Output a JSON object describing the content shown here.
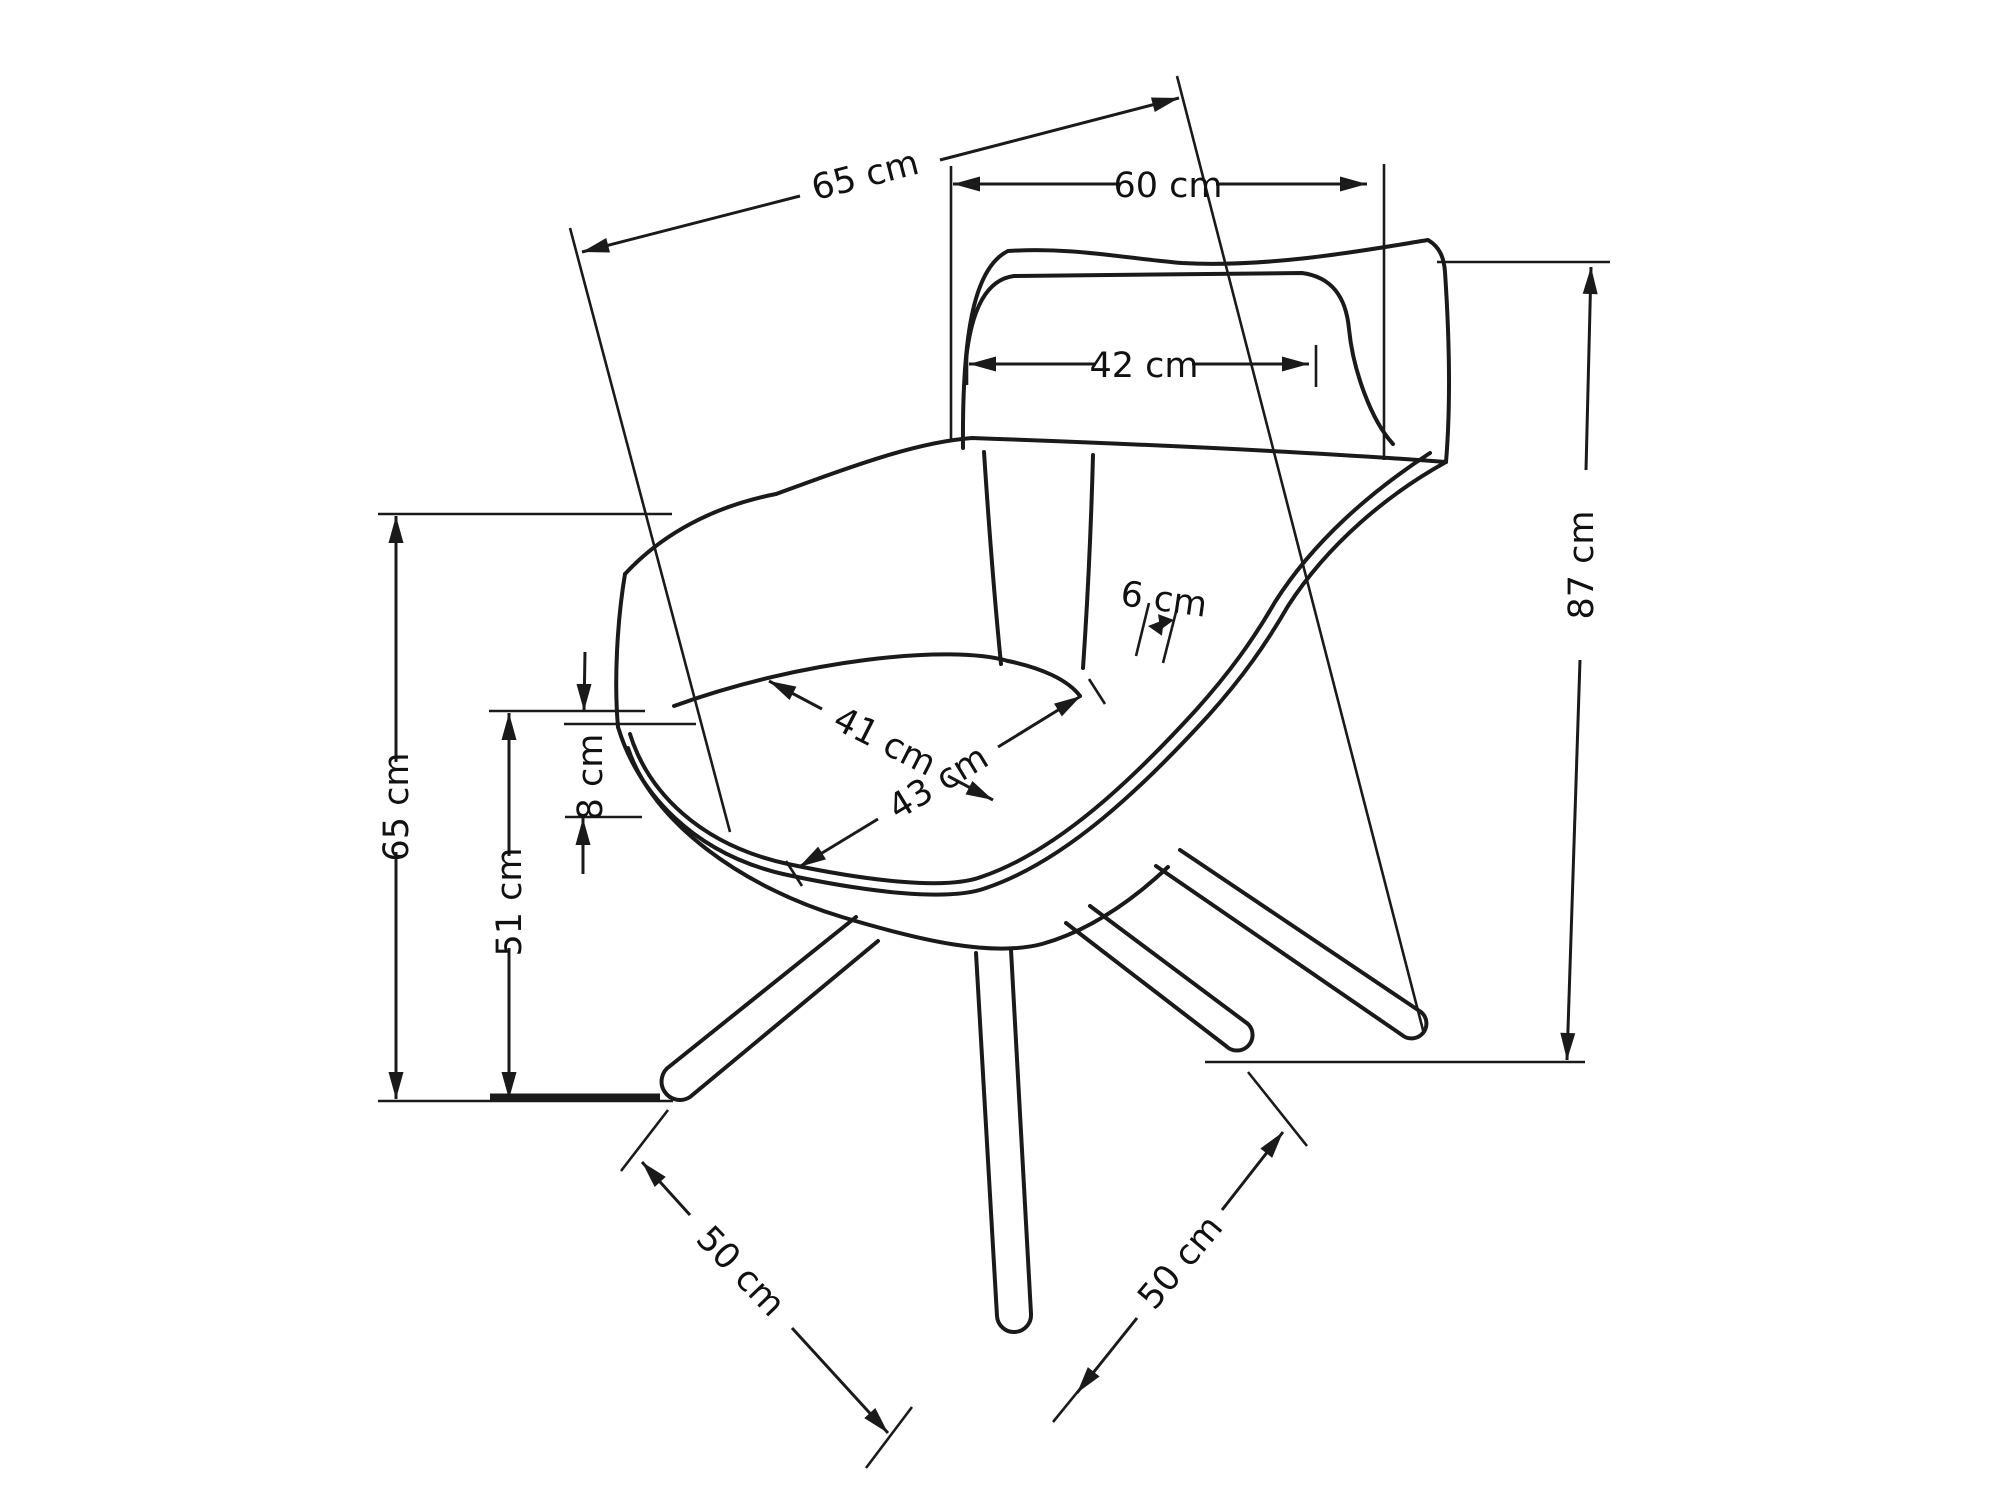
{
  "page": {
    "background": "#ffffff",
    "line_color": "#1a1a1a",
    "unit": "cm"
  },
  "diagram": {
    "kind": "furniture dimension line drawing",
    "subject": "swivel armchair, perspective view, technical measurement sketch",
    "measurements": {
      "overall_depth_cm": 65,
      "backrest_width_cm": 60,
      "headrest_width_cm": 42,
      "rim_thickness_cm": 6,
      "seat_depth_cm": 41,
      "seat_width_cm": 43,
      "overall_height_cm": 87,
      "armrest_height_cm": 65,
      "seat_height_cm": 51,
      "cushion_thickness_cm": 8,
      "base_span_left_cm": 50,
      "base_span_right_cm": 50
    }
  },
  "dimensions": [
    {
      "id": "overall-depth",
      "label": "65 cm",
      "value": 65,
      "segments": [
        [
          582,
          252,
          800,
          196
        ],
        [
          940,
          160,
          1179,
          98
        ]
      ],
      "arrows": [
        [
          582,
          252,
          165.5
        ],
        [
          1179,
          98,
          -14.5
        ]
      ],
      "exts": [
        [
          570,
          228,
          730,
          832
        ],
        [
          1177,
          76,
          1424,
          1034
        ]
      ],
      "text": [
        865,
        175,
        -14.5
      ]
    },
    {
      "id": "backrest-width",
      "label": "60 cm",
      "value": 60,
      "segments": [
        [
          953,
          184,
          1120,
          184
        ],
        [
          1216,
          184,
          1367,
          184
        ]
      ],
      "arrows": [
        [
          953,
          184,
          180
        ],
        [
          1367,
          184,
          0
        ]
      ],
      "exts": [
        [
          951,
          166,
          951,
          442
        ],
        [
          1384,
          164,
          1384,
          460
        ]
      ],
      "text": [
        1168,
        185,
        0
      ]
    },
    {
      "id": "headrest-width",
      "label": "42 cm",
      "value": 42,
      "segments": [
        [
          969,
          364,
          1096,
          364
        ],
        [
          1192,
          364,
          1309,
          364
        ]
      ],
      "arrows": [
        [
          969,
          364,
          180
        ],
        [
          1309,
          364,
          0
        ]
      ],
      "exts": [
        [
          967,
          345,
          967,
          385
        ],
        [
          1316,
          345,
          1316,
          387
        ]
      ],
      "text": [
        1144,
        365,
        0
      ]
    },
    {
      "id": "rim-thickness",
      "label": "6 cm",
      "value": 6,
      "alen": 15,
      "aw": 16,
      "segments": [],
      "arrows": [
        [
          1148,
          626,
          187
        ],
        [
          1174,
          620,
          -8
        ]
      ],
      "exts": [
        [
          1149,
          603,
          1136,
          656
        ],
        [
          1177,
          608,
          1163,
          663
        ]
      ],
      "text": [
        1164,
        599,
        8
      ]
    },
    {
      "id": "seat-depth",
      "label": "41 cm",
      "value": 41,
      "segments": [
        [
          769,
          681,
          822,
          709
        ],
        [
          948,
          776,
          993,
          800
        ]
      ],
      "arrows": [
        [
          769,
          681,
          207.2
        ],
        [
          993,
          800,
          27.2
        ]
      ],
      "exts": [],
      "text": [
        885,
        741,
        27
      ]
    },
    {
      "id": "seat-width",
      "label": "43 cm",
      "value": 43,
      "segments": [
        [
          799,
          867,
          878,
          819
        ],
        [
          998,
          747,
          1081,
          696
        ]
      ],
      "arrows": [
        [
          799,
          867,
          148.7
        ],
        [
          1081,
          696,
          -31.3
        ]
      ],
      "exts": [
        [
          786,
          861,
          802,
          886
        ],
        [
          1089,
          679,
          1105,
          704
        ]
      ],
      "text": [
        938,
        782,
        -31.3
      ]
    },
    {
      "id": "overall-height",
      "label": "87 cm",
      "value": 87,
      "segments": [
        [
          1591,
          267,
          1586,
          470
        ],
        [
          1580,
          660,
          1567,
          1060
        ]
      ],
      "arrows": [
        [
          1591,
          267,
          -88.3
        ],
        [
          1567,
          1060,
          91.7
        ]
      ],
      "exts": [
        [
          1437,
          262,
          1610,
          262
        ],
        [
          1205,
          1062,
          1585,
          1062
        ]
      ],
      "text": [
        1581,
        565,
        -90
      ]
    },
    {
      "id": "armrest-height",
      "label": "65 cm",
      "value": 65,
      "segments": [
        [
          396,
          516,
          396,
          762
        ],
        [
          396,
          852,
          396,
          1099
        ]
      ],
      "arrows": [
        [
          396,
          516,
          -90
        ],
        [
          396,
          1099,
          90
        ]
      ],
      "exts": [
        [
          378,
          514,
          672,
          514
        ]
      ],
      "text": [
        396,
        807,
        -90
      ]
    },
    {
      "id": "seat-height",
      "label": "51 cm",
      "value": 51,
      "segments": [
        [
          509,
          713,
          509,
          856
        ],
        [
          509,
          948,
          509,
          1099
        ]
      ],
      "arrows": [
        [
          509,
          713,
          -90
        ],
        [
          509,
          1099,
          90
        ]
      ],
      "exts": [
        [
          378,
          1101,
          673,
          1101
        ]
      ],
      "text": [
        509,
        902,
        -90
      ]
    },
    {
      "id": "cushion-thickness",
      "label": "8 cm",
      "value": 8,
      "segments": [
        [
          585,
          652,
          584,
          711
        ],
        [
          583,
          874,
          583,
          818
        ]
      ],
      "arrows": [
        [
          584,
          711,
          90
        ],
        [
          583,
          818,
          -90
        ]
      ],
      "exts": [
        [
          489,
          711,
          645,
          711
        ],
        [
          564,
          724,
          696,
          724
        ],
        [
          565,
          817,
          642,
          817
        ]
      ],
      "text": [
        590,
        777,
        -90
      ]
    },
    {
      "id": "base-span-left",
      "label": "50 cm",
      "value": 50,
      "segments": [
        [
          642,
          1162,
          690,
          1215
        ],
        [
          792,
          1328,
          888,
          1433
        ]
      ],
      "arrows": [
        [
          642,
          1162,
          227.6
        ],
        [
          888,
          1433,
          47.6
        ]
      ],
      "exts": [
        [
          668,
          1110,
          621,
          1171
        ],
        [
          912,
          1407,
          866,
          1468
        ]
      ],
      "text": [
        741,
        1271,
        46
      ]
    },
    {
      "id": "base-span-right",
      "label": "50 cm",
      "value": 50,
      "segments": [
        [
          1077,
          1393,
          1137,
          1318
        ],
        [
          1222,
          1210,
          1283,
          1132
        ]
      ],
      "arrows": [
        [
          1077,
          1393,
          128.3
        ],
        [
          1283,
          1132,
          -51.7
        ]
      ],
      "exts": [
        [
          1053,
          1422,
          1097,
          1368
        ],
        [
          1248,
          1072,
          1307,
          1146
        ]
      ],
      "text": [
        1180,
        1262,
        -50
      ]
    }
  ],
  "reference_lines": [
    {
      "id": "floor-left-heavy",
      "x1": 490,
      "y1": 1097,
      "x2": 660,
      "y2": 1097,
      "w": 7
    }
  ]
}
